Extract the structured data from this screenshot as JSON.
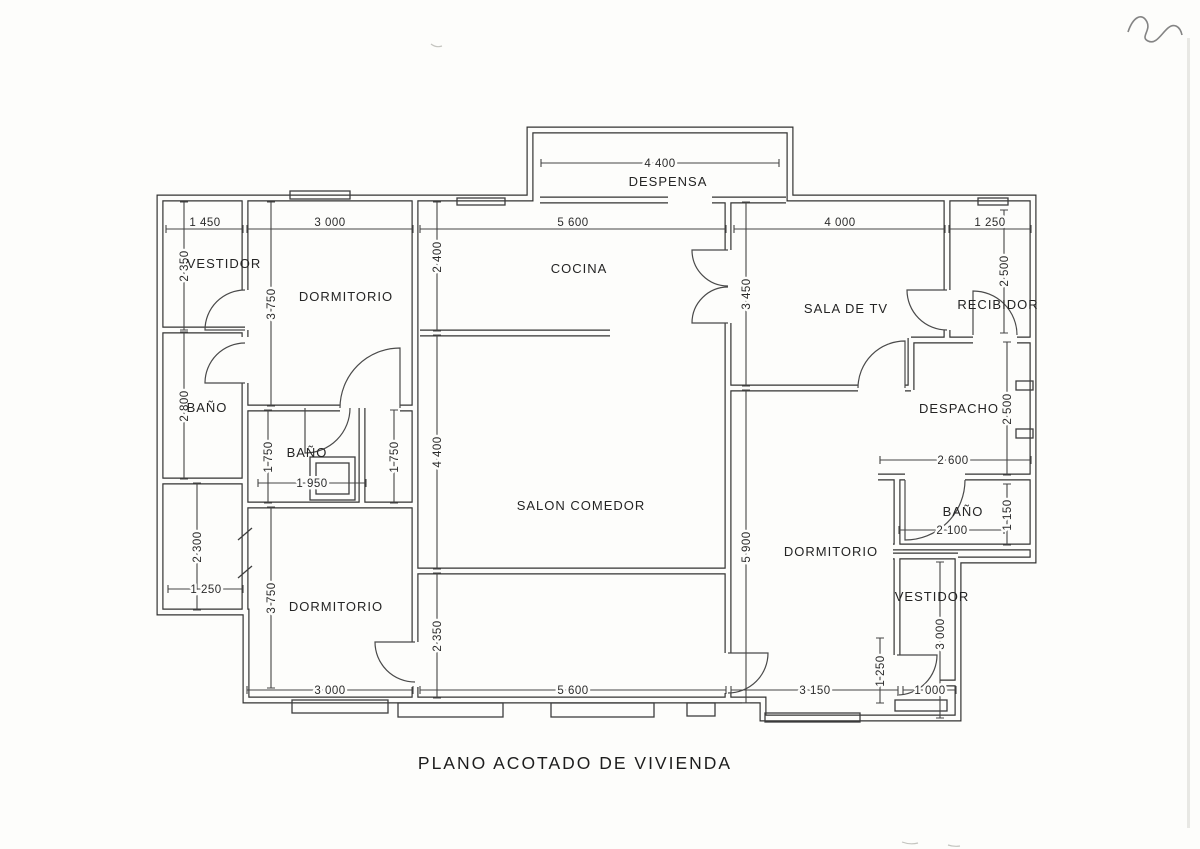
{
  "title": "PLANO ACOTADO DE VIVIENDA",
  "rooms": {
    "despensa": "DESPENSA",
    "cocina": "COCINA",
    "vestidor_top": "VESTIDOR",
    "dormitorio_top": "DORMITORIO",
    "bano_left": "BAÑO",
    "bano_middle": "BAÑO",
    "salon": "SALON COMEDOR",
    "sala_tv": "SALA DE TV",
    "recibidor": "RECIBIDOR",
    "despacho": "DESPACHO",
    "bano_right": "BAÑO",
    "dormitorio_right": "DORMITORIO",
    "vestidor_bottom": "VESTIDOR",
    "dormitorio_bottom": "DORMITORIO"
  },
  "dims_h": [
    "4 400",
    "1 450",
    "3 000",
    "5 600",
    "4 000",
    "1 250",
    "1 950",
    "2 600",
    "2 100",
    "1 250",
    "3 000",
    "5 600",
    "3 150",
    "1 000"
  ],
  "dims_v": [
    "2 350",
    "2 800",
    "2 300",
    "3 750",
    "1 750",
    "3 750",
    "1 750",
    "2 400",
    "4 400",
    "2 350",
    "3 450",
    "5 900",
    "2 500",
    "2 500",
    "1 150",
    "3 000",
    "1 250"
  ]
}
